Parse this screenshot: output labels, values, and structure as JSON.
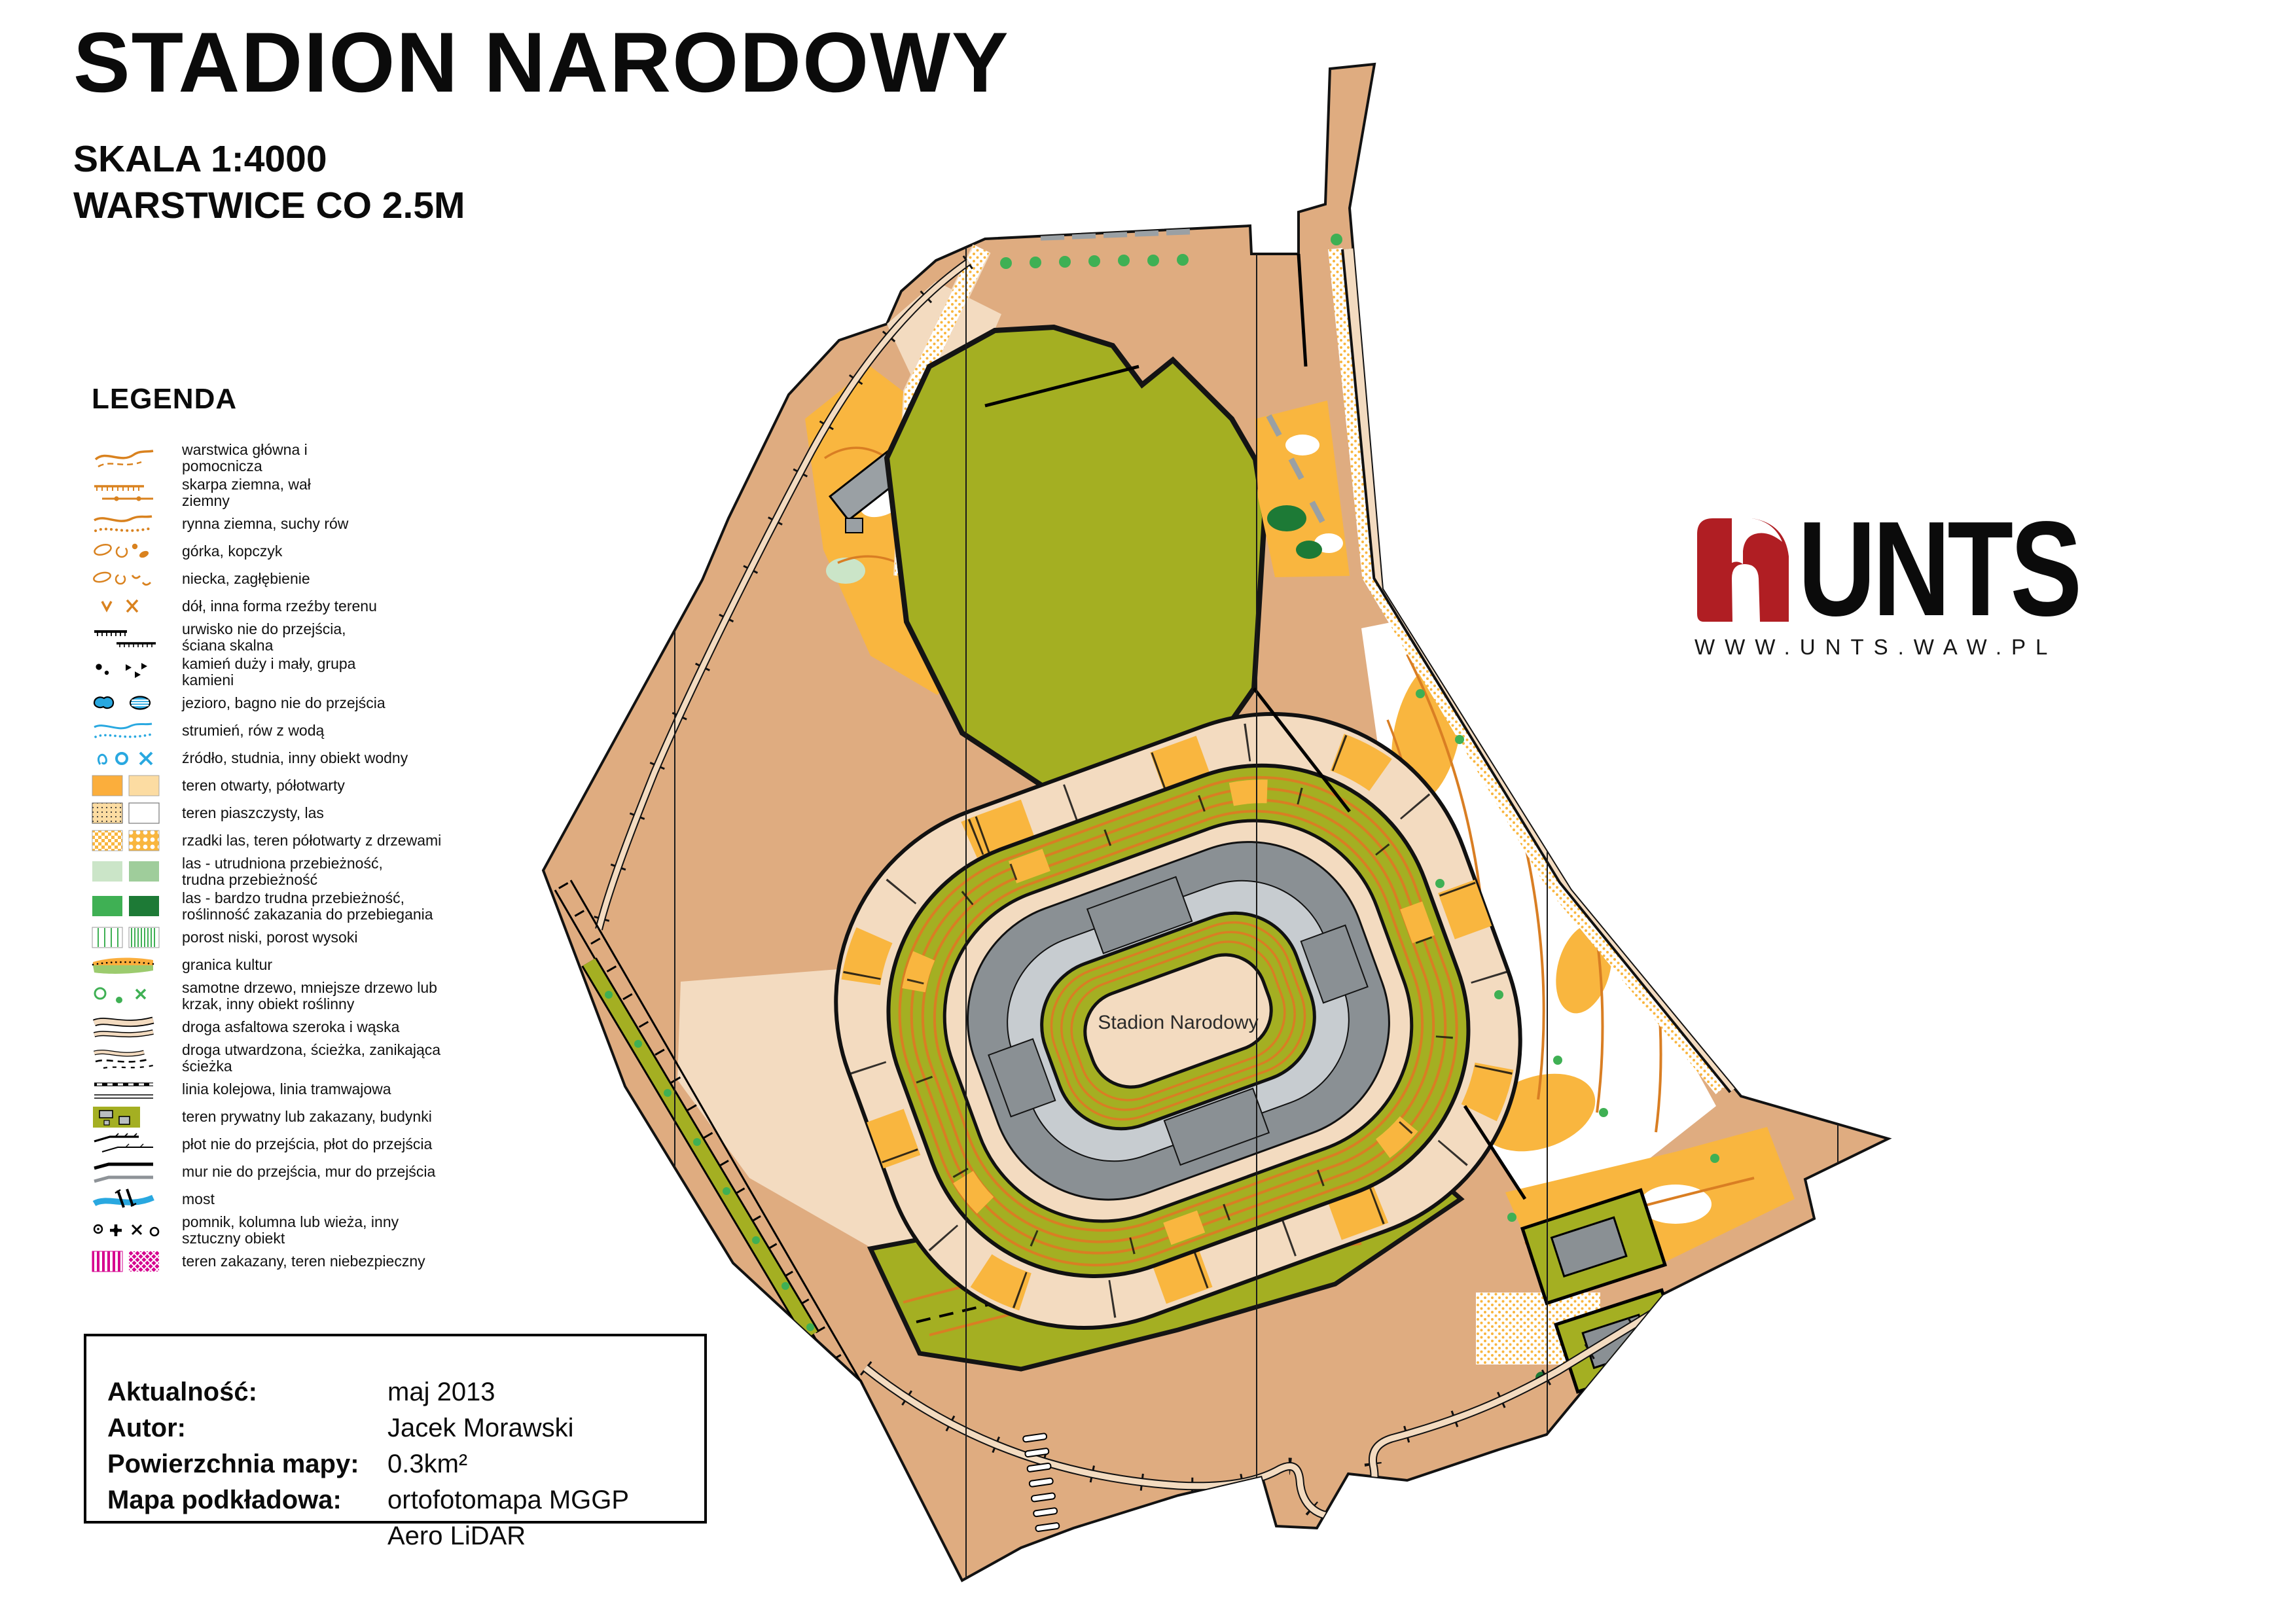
{
  "header": {
    "title": "STADION NARODOWY",
    "scale_line": "SKALA 1:4000",
    "contour_line": "WARSTWICE CO 2.5M"
  },
  "legend": {
    "heading": "LEGENDA",
    "items": [
      {
        "icon": "contour-lines",
        "label": "warstwica główna i\npomocnicza"
      },
      {
        "icon": "earth-bank",
        "label": "skarpa ziemna, wał\nziemny"
      },
      {
        "icon": "dry-ditch",
        "label": "rynna ziemna, suchy rów"
      },
      {
        "icon": "knoll",
        "label": "górka, kopczyk"
      },
      {
        "icon": "depression",
        "label": "niecka, zagłębienie"
      },
      {
        "icon": "pit",
        "label": "dół, inna forma rzeźby terenu"
      },
      {
        "icon": "cliff",
        "label": "urwisko nie do przejścia,\nściana skalna"
      },
      {
        "icon": "stones",
        "label": "kamień duży i mały, grupa\nkamieni"
      },
      {
        "icon": "lake",
        "label": "jezioro, bagno nie do przejścia"
      },
      {
        "icon": "stream",
        "label": "strumień, rów z wodą"
      },
      {
        "icon": "spring",
        "label": "źródło, studnia, inny obiekt wodny"
      },
      {
        "icon": "open-land",
        "label": "teren otwarty, półotwarty"
      },
      {
        "icon": "sandy-ground",
        "label": "teren piaszczysty, las"
      },
      {
        "icon": "sparse-forest",
        "label": "rzadki las, teren półotwarty z drzewami"
      },
      {
        "icon": "forest-slow",
        "label": "las - utrudniona przebieżność,\ntrudna przebieżność"
      },
      {
        "icon": "forest-fight",
        "label": "las - bardzo trudna przebieżność,\nroślinność zakazania do przebiegania"
      },
      {
        "icon": "undergrowth",
        "label": "porost niski, porost wysoki"
      },
      {
        "icon": "cultivation-boundary",
        "label": "granica kultur"
      },
      {
        "icon": "lone-tree",
        "label": "samotne drzewo, mniejsze drzewo lub\nkrzak, inny obiekt roślinny"
      },
      {
        "icon": "asphalt-road",
        "label": "droga asfaltowa szeroka i wąska"
      },
      {
        "icon": "dirt-path",
        "label": "droga utwardzona, ścieżka, zanikająca\nścieżka"
      },
      {
        "icon": "railway",
        "label": "linia kolejowa, linia tramwajowa"
      },
      {
        "icon": "private-area",
        "label": "teren prywatny lub zakazany, budynki"
      },
      {
        "icon": "fence",
        "label": "płot nie do przejścia, płot do przejścia"
      },
      {
        "icon": "wall",
        "label": "mur nie do przejścia, mur do przejścia"
      },
      {
        "icon": "bridge",
        "label": "most"
      },
      {
        "icon": "monument",
        "label": "pomnik, kolumna lub wieża, inny\nsztuczny obiekt"
      },
      {
        "icon": "forbidden-area",
        "label": "teren zakazany, teren niebezpieczny"
      }
    ]
  },
  "info": {
    "rows": [
      {
        "label": "Aktualność:",
        "value": "maj 2013"
      },
      {
        "label": "Autor:",
        "value": "Jacek Morawski"
      },
      {
        "label": "Powierzchnia mapy:",
        "value": "0.3km²"
      },
      {
        "label": "Mapa podkładowa:",
        "value": "ortofotomapa MGGP Aero LiDAR"
      }
    ]
  },
  "logo": {
    "name": "UNTS",
    "url": "WWW.UNTS.WAW.PL"
  },
  "map": {
    "label": "Stadion Narodowy"
  },
  "colors": {
    "open_tan": "#DFAC80",
    "paved_beige": "#F3DBC0",
    "olive_private": "#A4AF22",
    "open_yellow": "#F9B63F",
    "contour_orange": "#D97E23",
    "building_dark_gray": "#8A9094",
    "canopy_light_gray": "#C7CCD0",
    "tree_green": "#3FB054",
    "dark_tree_green": "#1D7A36",
    "water_blue": "#29A8E0",
    "forbidden_magenta": "#D6008F",
    "logo_red": "#B01E23"
  }
}
